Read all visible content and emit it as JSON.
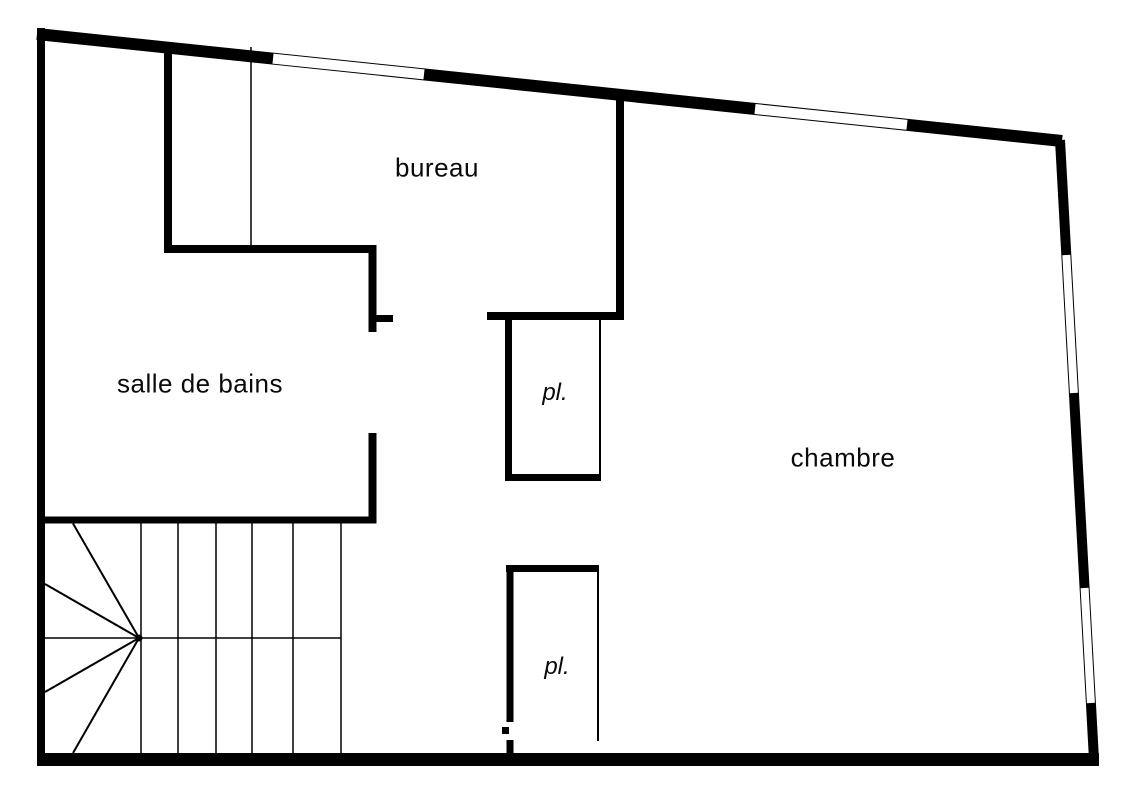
{
  "plan": {
    "background_color": "#ffffff",
    "wall_color": "#000000",
    "window_fill_color": "#ffffff",
    "canvas": {
      "width": 1131,
      "height": 800
    },
    "rooms": [
      {
        "id": "bureau",
        "label": "bureau",
        "x": 437,
        "y": 168,
        "style": "room"
      },
      {
        "id": "salle-de-bains",
        "label": "salle de bains",
        "x": 200,
        "y": 384,
        "style": "room"
      },
      {
        "id": "chambre",
        "label": "chambre",
        "x": 843,
        "y": 458,
        "style": "room"
      },
      {
        "id": "placard-haut",
        "label": "pl.",
        "x": 555,
        "y": 393,
        "style": "closet"
      },
      {
        "id": "placard-bas",
        "label": "pl.",
        "x": 557,
        "y": 667,
        "style": "closet"
      }
    ],
    "geometry": {
      "viewbox": "0 0 1131 800",
      "walls": [
        {
          "name": "exterior-wall-top",
          "x1": 37,
          "y1": 34,
          "x2": 1062,
          "y2": 141,
          "w": 12
        },
        {
          "name": "exterior-wall-left",
          "x1": 41,
          "y1": 28,
          "x2": 41,
          "y2": 766,
          "w": 8
        },
        {
          "name": "exterior-wall-bottom",
          "x1": 37,
          "y1": 759.5,
          "x2": 1099,
          "y2": 759.5,
          "w": 13
        },
        {
          "name": "exterior-wall-right",
          "x1": 1060,
          "y1": 140,
          "x2": 1094,
          "y2": 759.5,
          "w": 10
        },
        {
          "name": "bathroom-nook-wall",
          "x1": 168,
          "y1": 42,
          "x2": 168,
          "y2": 253,
          "w": 8
        },
        {
          "name": "bureau-bathroom-wall",
          "x1": 164,
          "y1": 249,
          "x2": 376,
          "y2": 249,
          "w": 8
        },
        {
          "name": "bathroom-door-jamb-upper",
          "x1": 372.5,
          "y1": 245,
          "x2": 372.5,
          "y2": 332,
          "w": 8
        },
        {
          "name": "bureau-door-stub",
          "x1": 369,
          "y1": 318.5,
          "x2": 393,
          "y2": 318.5,
          "w": 7
        },
        {
          "name": "closet-top-wall",
          "x1": 487,
          "y1": 316,
          "x2": 624,
          "y2": 316,
          "w": 8
        },
        {
          "name": "bureau-chambre-wall",
          "x1": 620,
          "y1": 92,
          "x2": 620,
          "y2": 320,
          "w": 8
        },
        {
          "name": "bathroom-door-jamb-lower",
          "x1": 372.5,
          "y1": 433,
          "x2": 372.5,
          "y2": 523.5,
          "w": 8
        },
        {
          "name": "stairwell-top-wall",
          "x1": 37,
          "y1": 520,
          "x2": 374,
          "y2": 520,
          "w": 7
        },
        {
          "name": "closet-upper-left-wall",
          "x1": 508.5,
          "y1": 313,
          "x2": 508.5,
          "y2": 481,
          "w": 7
        },
        {
          "name": "closet-upper-bottom-wall",
          "x1": 505,
          "y1": 477.5,
          "x2": 601,
          "y2": 477.5,
          "w": 7
        },
        {
          "name": "closet-lower-top-wall",
          "x1": 506,
          "y1": 568.5,
          "x2": 599,
          "y2": 568.5,
          "w": 7
        },
        {
          "name": "closet-lower-left-wall",
          "x1": 510,
          "y1": 565,
          "x2": 510,
          "y2": 722,
          "w": 7
        },
        {
          "name": "closet-lower-left-wall-base",
          "x1": 510,
          "y1": 740,
          "x2": 510,
          "y2": 754,
          "w": 7
        },
        {
          "name": "door-hinge-tick",
          "x1": 502,
          "y1": 730.5,
          "x2": 509,
          "y2": 730.5,
          "w": 7
        }
      ],
      "thin_partitions": [
        {
          "name": "bathroom-nook-partition",
          "x1": 251,
          "y1": 47,
          "x2": 251,
          "y2": 249,
          "w": 1.5
        },
        {
          "name": "closet-upper-door-line",
          "x1": 600,
          "y1": 319,
          "x2": 600,
          "y2": 474,
          "w": 2
        },
        {
          "name": "closet-lower-door-line",
          "x1": 598,
          "y1": 572,
          "x2": 598,
          "y2": 741,
          "w": 2
        }
      ],
      "stairs": {
        "treads": [
          {
            "name": "stair-tread",
            "x1": 141,
            "y1": 523,
            "x2": 141,
            "y2": 753,
            "w": 1.5
          },
          {
            "name": "stair-tread",
            "x1": 178,
            "y1": 523,
            "x2": 178,
            "y2": 753,
            "w": 1.5
          },
          {
            "name": "stair-tread",
            "x1": 216,
            "y1": 523,
            "x2": 216,
            "y2": 753,
            "w": 1.5
          },
          {
            "name": "stair-tread",
            "x1": 252,
            "y1": 523,
            "x2": 252,
            "y2": 753,
            "w": 1.5
          },
          {
            "name": "stair-tread",
            "x1": 293,
            "y1": 523,
            "x2": 293,
            "y2": 753,
            "w": 1.5
          },
          {
            "name": "stair-tread",
            "x1": 341,
            "y1": 523,
            "x2": 341,
            "y2": 753,
            "w": 1.5
          },
          {
            "name": "stair-mid-line",
            "x1": 45,
            "y1": 638,
            "x2": 341,
            "y2": 638,
            "w": 1.5
          }
        ],
        "winder_fan": [
          {
            "name": "stair-winder-line",
            "x1": 139,
            "y1": 638,
            "x2": 73,
            "y2": 523.5,
            "w": 2
          },
          {
            "name": "stair-winder-line",
            "x1": 139,
            "y1": 638,
            "x2": 45,
            "y2": 584,
            "w": 2
          },
          {
            "name": "stair-winder-line",
            "x1": 139,
            "y1": 638,
            "x2": 45,
            "y2": 692,
            "w": 2
          },
          {
            "name": "stair-winder-line",
            "x1": 139,
            "y1": 638,
            "x2": 73,
            "y2": 753,
            "w": 2
          }
        ],
        "center_dot": {
          "name": "stair-center-dot",
          "cx": 139,
          "cy": 638,
          "r": 3.5
        }
      },
      "windows": [
        {
          "name": "window-top-left",
          "x1": 273,
          "y1": 58.6,
          "x2": 424,
          "y2": 74.4,
          "w": 10
        },
        {
          "name": "window-top-right",
          "x1": 755,
          "y1": 109,
          "x2": 907,
          "y2": 124.8,
          "w": 10
        },
        {
          "name": "window-right-upper",
          "x1": 1066.3,
          "y1": 255,
          "x2": 1073.9,
          "y2": 393,
          "w": 8
        },
        {
          "name": "window-right-lower",
          "x1": 1084.6,
          "y1": 588,
          "x2": 1090.9,
          "y2": 703,
          "w": 8
        }
      ]
    }
  }
}
